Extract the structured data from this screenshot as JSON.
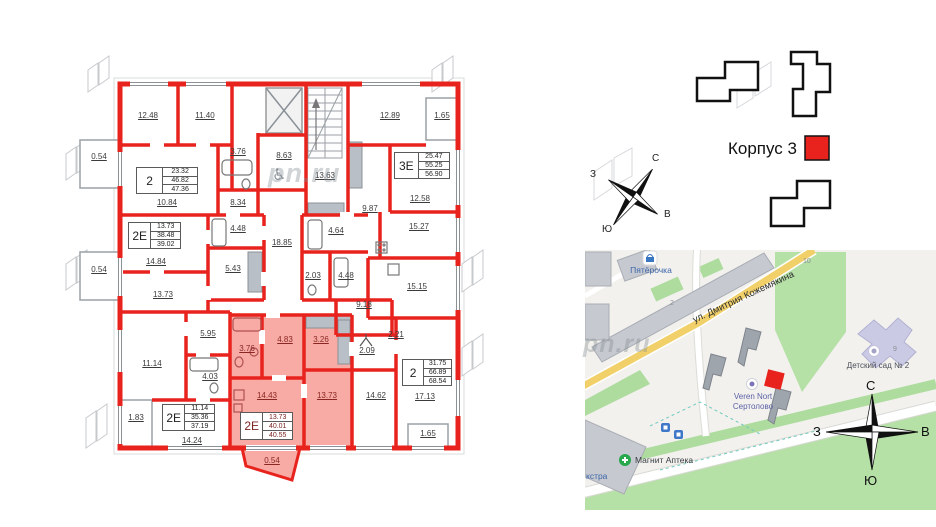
{
  "colors": {
    "wall_red": "#e8231d",
    "highlight_pink": "#f7aba4",
    "map_green": "#b5e0a6",
    "road_yellow": "#f1d06a"
  },
  "floorplan": {
    "watermark": "pn.ru",
    "area_labels": [
      {
        "v": "12.48",
        "x": 148,
        "y": 116
      },
      {
        "v": "11.40",
        "x": 205,
        "y": 116
      },
      {
        "v": "12.89",
        "x": 390,
        "y": 116
      },
      {
        "v": "1.65",
        "x": 442,
        "y": 116
      },
      {
        "v": "3.76",
        "x": 238,
        "y": 152
      },
      {
        "v": "8.63",
        "x": 284,
        "y": 156
      },
      {
        "v": "13.63",
        "x": 325,
        "y": 176
      },
      {
        "v": "10.84",
        "x": 167,
        "y": 203
      },
      {
        "v": "8.34",
        "x": 238,
        "y": 203
      },
      {
        "v": "9.87",
        "x": 370,
        "y": 209
      },
      {
        "v": "12.58",
        "x": 420,
        "y": 199
      },
      {
        "v": "0.54",
        "x": 99,
        "y": 157
      },
      {
        "v": "4.48",
        "x": 238,
        "y": 229
      },
      {
        "v": "18.85",
        "x": 282,
        "y": 243
      },
      {
        "v": "4.64",
        "x": 336,
        "y": 231
      },
      {
        "v": "15.27",
        "x": 419,
        "y": 227
      },
      {
        "v": "14.84",
        "x": 156,
        "y": 262
      },
      {
        "v": "5.43",
        "x": 233,
        "y": 269
      },
      {
        "v": "0.54",
        "x": 99,
        "y": 270
      },
      {
        "v": "2.03",
        "x": 313,
        "y": 276
      },
      {
        "v": "4.48",
        "x": 346,
        "y": 276
      },
      {
        "v": "15.15",
        "x": 417,
        "y": 287
      },
      {
        "v": "13.73",
        "x": 163,
        "y": 295
      },
      {
        "v": "9.18",
        "x": 364,
        "y": 305
      },
      {
        "v": "5.95",
        "x": 208,
        "y": 334
      },
      {
        "v": "2.21",
        "x": 396,
        "y": 335
      },
      {
        "v": "2.09",
        "x": 367,
        "y": 351
      },
      {
        "v": "11.14",
        "x": 152,
        "y": 364
      },
      {
        "v": "4.03",
        "x": 210,
        "y": 377
      },
      {
        "v": "3.76",
        "x": 247,
        "y": 349,
        "hl": true
      },
      {
        "v": "4.83",
        "x": 285,
        "y": 340,
        "hl": true
      },
      {
        "v": "3.26",
        "x": 321,
        "y": 340,
        "hl": true
      },
      {
        "v": "14.43",
        "x": 267,
        "y": 396,
        "hl": true
      },
      {
        "v": "13.73",
        "x": 327,
        "y": 396,
        "hl": true
      },
      {
        "v": "14.62",
        "x": 376,
        "y": 396
      },
      {
        "v": "17.13",
        "x": 425,
        "y": 397
      },
      {
        "v": "1.65",
        "x": 428,
        "y": 434
      },
      {
        "v": "14.24",
        "x": 192,
        "y": 441
      },
      {
        "v": "1.83",
        "x": 136,
        "y": 418
      },
      {
        "v": "0.54",
        "x": 272,
        "y": 461,
        "hl": true
      }
    ],
    "apartments": [
      {
        "type": "2",
        "values": [
          "23.32",
          "46.82",
          "47.36"
        ],
        "x": 136,
        "y": 167,
        "w": 62,
        "h": 27
      },
      {
        "type": "3Е",
        "values": [
          "25.47",
          "55.25",
          "56.90"
        ],
        "x": 394,
        "y": 152,
        "w": 56,
        "h": 27
      },
      {
        "type": "2Е",
        "values": [
          "13.73",
          "38.48",
          "39.02"
        ],
        "x": 128,
        "y": 222,
        "w": 53,
        "h": 27
      },
      {
        "type": "2",
        "values": [
          "31.75",
          "66.89",
          "68.54"
        ],
        "x": 402,
        "y": 359,
        "w": 50,
        "h": 27
      },
      {
        "type": "2Е",
        "values": [
          "11.14",
          "35.36",
          "37.19"
        ],
        "x": 162,
        "y": 404,
        "w": 53,
        "h": 27
      },
      {
        "type": "2Е",
        "values": [
          "13.73",
          "40.01",
          "40.55"
        ],
        "x": 240,
        "y": 412,
        "w": 53,
        "h": 28,
        "hl": true
      }
    ]
  },
  "site_plan": {
    "korpus_label": "Корпус 3",
    "compass": {
      "n": "С",
      "e": "В",
      "s": "Ю",
      "w": "З"
    }
  },
  "map": {
    "street": "ул. Дмитрия Кожемякина",
    "watermark": "pn.ru",
    "pois": {
      "pyaterochka": "Пятёрочка",
      "veren_line1": "Veren Nort",
      "veren_line2": "Сертолово",
      "kindergarten": "Детский сад № 2",
      "magnit": "Магнит Аптека",
      "ekstra": "кстра"
    },
    "house_numbers": {
      "n2": "2",
      "n10": "10",
      "n9": "9"
    },
    "compass": {
      "n": "С",
      "e": "В",
      "s": "Ю",
      "w": "З"
    }
  }
}
